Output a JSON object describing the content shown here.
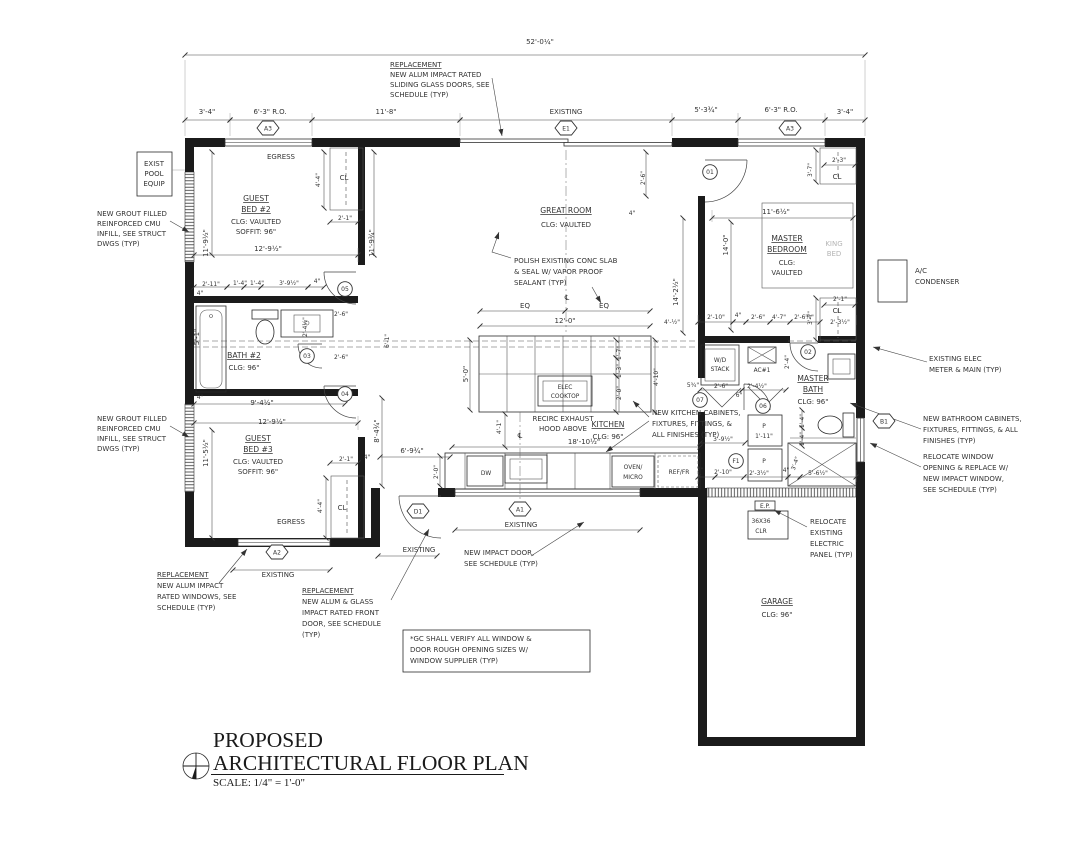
{
  "title_block": {
    "line1": "PROPOSED",
    "line2": "ARCHITECTURAL FLOOR PLAN",
    "scale": "SCALE: 1/4\" = 1'-0\""
  },
  "colors": {
    "ink": "#1b1b1b",
    "gray": "#b5b5b5",
    "bg": "#ffffff"
  },
  "hex_markers": [
    {
      "t": "A3",
      "x": 268,
      "y": 128
    },
    {
      "t": "E1",
      "x": 566,
      "y": 128
    },
    {
      "t": "A3",
      "x": 790,
      "y": 128
    },
    {
      "t": "A2",
      "x": 277,
      "y": 552
    },
    {
      "t": "D1",
      "x": 418,
      "y": 511
    },
    {
      "t": "A1",
      "x": 520,
      "y": 509
    },
    {
      "t": "B1",
      "x": 884,
      "y": 421
    }
  ],
  "circle_markers": [
    {
      "t": "01",
      "x": 710,
      "y": 172
    },
    {
      "t": "02",
      "x": 808,
      "y": 352
    },
    {
      "t": "05",
      "x": 345,
      "y": 289
    },
    {
      "t": "03",
      "x": 307,
      "y": 356
    },
    {
      "t": "04",
      "x": 345,
      "y": 394
    },
    {
      "t": "07",
      "x": 700,
      "y": 400
    },
    {
      "t": "06",
      "x": 763,
      "y": 406
    },
    {
      "t": "F1",
      "x": 736,
      "y": 461
    }
  ],
  "texts": [
    {
      "n": "dim-overall",
      "t": "52'-0¼\"",
      "x": 540,
      "y": 44
    },
    {
      "n": "note-slider-1",
      "t": "REPLACEMENT",
      "x": 390,
      "y": 67,
      "a": 1,
      "c": "u"
    },
    {
      "n": "note-slider-2",
      "t": "NEW ALUM IMPACT RATED",
      "x": 390,
      "y": 77,
      "a": 1
    },
    {
      "n": "note-slider-3",
      "t": "SLIDING GLASS DOORS, SEE",
      "x": 390,
      "y": 87,
      "a": 1
    },
    {
      "n": "note-slider-4",
      "t": "SCHEDULE (TYP)",
      "x": 390,
      "y": 97,
      "a": 1
    },
    {
      "t": "3'-4\"",
      "x": 207,
      "y": 114
    },
    {
      "t": "6'-3\" R.O.",
      "x": 270,
      "y": 114
    },
    {
      "t": "11'-8\"",
      "x": 386,
      "y": 114
    },
    {
      "t": "EXISTING",
      "x": 566,
      "y": 114
    },
    {
      "t": "5'-3¾\"",
      "x": 706,
      "y": 112
    },
    {
      "t": "6'-3\" R.O.",
      "x": 781,
      "y": 112
    },
    {
      "t": "3'-4\"",
      "x": 845,
      "y": 114
    },
    {
      "n": "label-pool-1",
      "t": "EXIST",
      "x": 154,
      "y": 166
    },
    {
      "n": "label-pool-2",
      "t": "POOL",
      "x": 154,
      "y": 176
    },
    {
      "n": "label-pool-3",
      "t": "EQUIP",
      "x": 154,
      "y": 186
    },
    {
      "n": "note-cmu1-1",
      "t": "NEW GROUT FILLED",
      "x": 97,
      "y": 216,
      "a": 1
    },
    {
      "n": "note-cmu1-2",
      "t": "REINFORCED CMU",
      "x": 97,
      "y": 226,
      "a": 1
    },
    {
      "n": "note-cmu1-3",
      "t": "INFILL, SEE STRUCT",
      "x": 97,
      "y": 236,
      "a": 1
    },
    {
      "n": "note-cmu1-4",
      "t": "DWGS (TYP)",
      "x": 97,
      "y": 246,
      "a": 1
    },
    {
      "n": "note-cmu2-1",
      "t": "NEW GROUT FILLED",
      "x": 97,
      "y": 421,
      "a": 1
    },
    {
      "n": "note-cmu2-2",
      "t": "REINFORCED CMU",
      "x": 97,
      "y": 431,
      "a": 1
    },
    {
      "n": "note-cmu2-3",
      "t": "INFILL, SEE STRUCT",
      "x": 97,
      "y": 441,
      "a": 1
    },
    {
      "n": "note-cmu2-4",
      "t": "DWGS (TYP)",
      "x": 97,
      "y": 451,
      "a": 1
    },
    {
      "n": "label-egress-top",
      "t": "EGRESS",
      "x": 281,
      "y": 159
    },
    {
      "n": "room-guest-bed-2",
      "t": "GUEST",
      "x": 256,
      "y": 201,
      "c": "room"
    },
    {
      "n": "room-guest-bed-2",
      "t": "BED #2",
      "x": 256,
      "y": 212,
      "c": "room"
    },
    {
      "t": "CLG: VAULTED",
      "x": 256,
      "y": 224
    },
    {
      "t": "SOFFIT: 96\"",
      "x": 256,
      "y": 234
    },
    {
      "t": "11'-9½\"",
      "x": 208,
      "y": 243,
      "r": -90
    },
    {
      "t": "4'-4\"",
      "x": 320,
      "y": 180,
      "r": -90,
      "c": "tiny"
    },
    {
      "n": "label-closet",
      "t": "CL",
      "x": 344,
      "y": 180
    },
    {
      "t": "2'-1\"",
      "x": 345,
      "y": 220,
      "c": "tiny"
    },
    {
      "t": "12'-9½\"",
      "x": 268,
      "y": 251
    },
    {
      "t": "11'-9¾\"",
      "x": 374,
      "y": 243,
      "r": -90
    },
    {
      "t": "2'-11\"",
      "x": 211,
      "y": 286,
      "c": "tiny"
    },
    {
      "t": "1'-4\"",
      "x": 240,
      "y": 285,
      "c": "tiny"
    },
    {
      "t": "1'-4\"",
      "x": 257,
      "y": 285,
      "c": "tiny"
    },
    {
      "t": "3'-9½\"",
      "x": 289,
      "y": 285,
      "c": "tiny"
    },
    {
      "t": "4\"",
      "x": 317,
      "y": 283,
      "c": "tiny"
    },
    {
      "t": "4\"",
      "x": 200,
      "y": 295,
      "c": "tiny"
    },
    {
      "t": "5'-1\"",
      "x": 199,
      "y": 337,
      "r": -90
    },
    {
      "n": "room-bath-2",
      "t": "BATH #2",
      "x": 244,
      "y": 358,
      "c": "room"
    },
    {
      "t": "CLG: 96\"",
      "x": 244,
      "y": 370
    },
    {
      "t": "2'-6\"",
      "x": 341,
      "y": 316,
      "c": "tiny"
    },
    {
      "t": "2'-4½\"",
      "x": 307,
      "y": 327,
      "r": -90,
      "c": "tiny"
    },
    {
      "t": "2'-6\"",
      "x": 341,
      "y": 359,
      "c": "tiny"
    },
    {
      "t": "6'-1\"",
      "x": 389,
      "y": 341,
      "r": -90,
      "c": "tiny"
    },
    {
      "t": "4\"",
      "x": 200,
      "y": 399,
      "c": "tiny"
    },
    {
      "t": "9'-4½\"",
      "x": 262,
      "y": 405
    },
    {
      "t": "12'-9½\"",
      "x": 272,
      "y": 424
    },
    {
      "t": "11'-5½\"",
      "x": 208,
      "y": 453,
      "r": -90
    },
    {
      "t": "8'-4¾\"",
      "x": 379,
      "y": 431,
      "r": -90
    },
    {
      "n": "room-guest-bed-3",
      "t": "GUEST",
      "x": 258,
      "y": 441,
      "c": "room"
    },
    {
      "n": "room-guest-bed-3",
      "t": "BED #3",
      "x": 258,
      "y": 452,
      "c": "room"
    },
    {
      "t": "CLG: VAULTED",
      "x": 258,
      "y": 464
    },
    {
      "t": "SOFFIT: 96\"",
      "x": 258,
      "y": 474
    },
    {
      "t": "2'-1\"",
      "x": 346,
      "y": 461,
      "c": "tiny"
    },
    {
      "t": "4\"",
      "x": 367,
      "y": 459,
      "c": "tiny"
    },
    {
      "t": "4'-4\"",
      "x": 322,
      "y": 506,
      "r": -90,
      "c": "tiny"
    },
    {
      "n": "label-closet",
      "t": "CL",
      "x": 342,
      "y": 510
    },
    {
      "n": "label-egress-bottom",
      "t": "EGRESS",
      "x": 291,
      "y": 524
    },
    {
      "t": "EXISTING",
      "x": 278,
      "y": 577
    },
    {
      "n": "room-great-room",
      "t": "GREAT ROOM",
      "x": 566,
      "y": 213,
      "c": "room"
    },
    {
      "t": "CLG: VAULTED",
      "x": 566,
      "y": 227
    },
    {
      "n": "note-slab-1",
      "t": "POLISH EXISTING CONC SLAB",
      "x": 514,
      "y": 263,
      "a": 1
    },
    {
      "n": "note-slab-2",
      "t": "& SEAL W/ VAPOR PROOF",
      "x": 514,
      "y": 274,
      "a": 1
    },
    {
      "n": "note-slab-3",
      "t": "SEALANT (TYP)",
      "x": 514,
      "y": 285,
      "a": 1
    },
    {
      "n": "centerline-symbol",
      "t": "℄",
      "x": 567,
      "y": 300
    },
    {
      "t": "EQ",
      "x": 525,
      "y": 308
    },
    {
      "t": "EQ",
      "x": 604,
      "y": 308
    },
    {
      "t": "12'-0\"",
      "x": 565,
      "y": 323
    },
    {
      "t": "14'-2½\"",
      "x": 678,
      "y": 292,
      "r": -90
    },
    {
      "t": "4'-½\"",
      "x": 672,
      "y": 324,
      "c": "tiny"
    },
    {
      "t": "2'-6\"",
      "x": 645,
      "y": 178,
      "r": -90,
      "c": "tiny"
    },
    {
      "t": "4\"",
      "x": 632,
      "y": 215,
      "c": "tiny"
    },
    {
      "t": "14'-0\"",
      "x": 728,
      "y": 245,
      "r": -90
    },
    {
      "t": "11'-6½\"",
      "x": 776,
      "y": 214
    },
    {
      "n": "room-master-bedroom",
      "t": "MASTER",
      "x": 787,
      "y": 241,
      "c": "room"
    },
    {
      "n": "room-master-bedroom",
      "t": "BEDROOM",
      "x": 787,
      "y": 252,
      "c": "room"
    },
    {
      "t": "CLG:",
      "x": 787,
      "y": 265
    },
    {
      "t": "VAULTED",
      "x": 787,
      "y": 275
    },
    {
      "n": "label-king-bed",
      "t": "KING",
      "x": 834,
      "y": 246,
      "c": "gray"
    },
    {
      "n": "label-king-bed",
      "t": "BED",
      "x": 834,
      "y": 256,
      "c": "gray"
    },
    {
      "t": "2'-3\"",
      "x": 839,
      "y": 162,
      "c": "tiny"
    },
    {
      "n": "label-closet",
      "t": "CL",
      "x": 837,
      "y": 179
    },
    {
      "t": "3'-7\"",
      "x": 812,
      "y": 170,
      "r": -90,
      "c": "tiny"
    },
    {
      "t": "2'-1\"",
      "x": 840,
      "y": 301,
      "c": "tiny"
    },
    {
      "n": "label-closet",
      "t": "CL",
      "x": 837,
      "y": 313
    },
    {
      "t": "2'-3½\"",
      "x": 840,
      "y": 324,
      "c": "tiny"
    },
    {
      "t": "3'-7\"",
      "x": 812,
      "y": 318,
      "r": -90,
      "c": "tiny"
    },
    {
      "t": "2'-10\"",
      "x": 716,
      "y": 319,
      "c": "tiny"
    },
    {
      "t": "4\"",
      "x": 738,
      "y": 317,
      "c": "tiny"
    },
    {
      "t": "2'-6\"",
      "x": 758,
      "y": 319,
      "c": "tiny"
    },
    {
      "t": "4'-7\"",
      "x": 779,
      "y": 319,
      "c": "tiny"
    },
    {
      "t": "2'-6⅝\"",
      "x": 804,
      "y": 319,
      "c": "tiny"
    },
    {
      "n": "label-wd-stack",
      "t": "W/D",
      "x": 720,
      "y": 362,
      "c": "tiny"
    },
    {
      "n": "label-wd-stack",
      "t": "STACK",
      "x": 720,
      "y": 371,
      "c": "tiny"
    },
    {
      "n": "label-ac1",
      "t": "AC#1",
      "x": 762,
      "y": 372,
      "c": "tiny"
    },
    {
      "t": "2'-6\"",
      "x": 721,
      "y": 388,
      "c": "tiny"
    },
    {
      "t": "2'-4½\"",
      "x": 757,
      "y": 388,
      "c": "tiny"
    },
    {
      "t": "6\"",
      "x": 739,
      "y": 397,
      "c": "tiny"
    },
    {
      "t": "5¾\"",
      "x": 693,
      "y": 387,
      "c": "tiny"
    },
    {
      "t": "2'-4\"",
      "x": 789,
      "y": 362,
      "r": -90,
      "c": "tiny"
    },
    {
      "n": "room-master-bath",
      "t": "MASTER",
      "x": 813,
      "y": 381,
      "c": "room"
    },
    {
      "n": "room-master-bath",
      "t": "BATH",
      "x": 813,
      "y": 392,
      "c": "room"
    },
    {
      "t": "CLG: 96\"",
      "x": 813,
      "y": 404
    },
    {
      "t": "1'-4\"",
      "x": 804,
      "y": 421,
      "r": -90,
      "c": "tiny"
    },
    {
      "t": "1'-4\"",
      "x": 804,
      "y": 439,
      "r": -90,
      "c": "tiny"
    },
    {
      "t": "5'-0\"",
      "x": 468,
      "y": 374,
      "r": -90
    },
    {
      "n": "label-cooktop",
      "t": "ELEC",
      "x": 565,
      "y": 389,
      "c": "tiny"
    },
    {
      "n": "label-cooktop",
      "t": "COOKTOP",
      "x": 565,
      "y": 398,
      "c": "tiny"
    },
    {
      "n": "note-hood-1",
      "t": "RECIRC EXHAUST",
      "x": 563,
      "y": 421
    },
    {
      "n": "note-hood-2",
      "t": "HOOD ABOVE",
      "x": 563,
      "y": 431
    },
    {
      "n": "room-kitchen",
      "t": "KITCHEN",
      "x": 608,
      "y": 427,
      "c": "room"
    },
    {
      "t": "CLG: 96\"",
      "x": 608,
      "y": 439
    },
    {
      "t": "1'-7\"",
      "x": 621,
      "y": 353,
      "r": -90,
      "c": "tiny"
    },
    {
      "t": "1'-3\"",
      "x": 621,
      "y": 371,
      "r": -90,
      "c": "tiny"
    },
    {
      "t": "2'-0\"",
      "x": 621,
      "y": 393,
      "r": -90,
      "c": "tiny"
    },
    {
      "t": "4'-10\"",
      "x": 658,
      "y": 377,
      "r": -90,
      "c": "tiny"
    },
    {
      "t": "4'-1\"",
      "x": 501,
      "y": 427,
      "r": -90,
      "c": "tiny"
    },
    {
      "n": "centerline-symbol",
      "t": "℄",
      "x": 520,
      "y": 438
    },
    {
      "t": "18'-10½\"",
      "x": 584,
      "y": 444
    },
    {
      "t": "2'-0\"",
      "x": 438,
      "y": 472,
      "r": -90,
      "c": "tiny"
    },
    {
      "t": "6'-9¾\"",
      "x": 412,
      "y": 453
    },
    {
      "n": "label-dishwasher",
      "t": "DW",
      "x": 486,
      "y": 475,
      "c": "tiny"
    },
    {
      "n": "label-oven",
      "t": "OVEN/",
      "x": 633,
      "y": 469,
      "c": "tiny"
    },
    {
      "n": "label-oven",
      "t": "MICRO",
      "x": 633,
      "y": 479,
      "c": "tiny"
    },
    {
      "n": "label-fridge",
      "t": "REF/FR",
      "x": 679,
      "y": 474,
      "c": "tiny"
    },
    {
      "n": "note-kitchen-cab-1",
      "t": "NEW KITCHEN CABINETS,",
      "x": 652,
      "y": 415,
      "a": 1
    },
    {
      "n": "note-kitchen-cab-2",
      "t": "FIXTURES, FITTINGS, &",
      "x": 652,
      "y": 426,
      "a": 1
    },
    {
      "n": "note-kitchen-cab-3",
      "t": "ALL FINISHES (TYP)",
      "x": 652,
      "y": 437,
      "a": 1
    },
    {
      "n": "label-pantry",
      "t": "P",
      "x": 764,
      "y": 428,
      "c": "tiny"
    },
    {
      "t": "1'-11\"",
      "x": 764,
      "y": 438,
      "c": "tiny"
    },
    {
      "n": "label-pantry",
      "t": "P",
      "x": 764,
      "y": 463,
      "c": "tiny"
    },
    {
      "t": "3'-9½\"",
      "x": 723,
      "y": 441,
      "c": "tiny"
    },
    {
      "t": "2'-10\"",
      "x": 723,
      "y": 474,
      "c": "tiny"
    },
    {
      "t": "7\"",
      "x": 700,
      "y": 472,
      "c": "tiny"
    },
    {
      "t": "2'-3½\"",
      "x": 759,
      "y": 475,
      "c": "tiny"
    },
    {
      "t": "4\"",
      "x": 786,
      "y": 472,
      "c": "tiny"
    },
    {
      "t": "5'-6½\"",
      "x": 818,
      "y": 475,
      "c": "tiny"
    },
    {
      "t": "3'-4\"",
      "x": 797,
      "y": 464,
      "r": -70,
      "c": "tiny"
    },
    {
      "n": "label-ac-cond-1",
      "t": "A/C",
      "x": 915,
      "y": 273,
      "a": 1
    },
    {
      "n": "label-ac-cond-2",
      "t": "CONDENSER",
      "x": 915,
      "y": 284,
      "a": 1
    },
    {
      "n": "note-meter-1",
      "t": "EXISTING ELEC",
      "x": 929,
      "y": 361,
      "a": 1
    },
    {
      "n": "note-meter-2",
      "t": "METER & MAIN (TYP)",
      "x": 929,
      "y": 372,
      "a": 1
    },
    {
      "n": "note-bath-cab-1",
      "t": "NEW  BATHROOM CABINETS,",
      "x": 923,
      "y": 421,
      "a": 1
    },
    {
      "n": "note-bath-cab-2",
      "t": "FIXTURES, FITTINGS, & ALL",
      "x": 923,
      "y": 432,
      "a": 1
    },
    {
      "n": "note-bath-cab-3",
      "t": "FINISHES (TYP)",
      "x": 923,
      "y": 443,
      "a": 1
    },
    {
      "n": "note-reloc-win-1",
      "t": "RELOCATE WINDOW",
      "x": 923,
      "y": 459,
      "a": 1
    },
    {
      "n": "note-reloc-win-2",
      "t": "OPENING & REPLACE W/",
      "x": 923,
      "y": 470,
      "a": 1
    },
    {
      "n": "note-reloc-win-3",
      "t": "NEW IMPACT WINDOW,",
      "x": 923,
      "y": 481,
      "a": 1
    },
    {
      "n": "note-reloc-win-4",
      "t": "SEE SCHEDULE (TYP)",
      "x": 923,
      "y": 492,
      "a": 1
    },
    {
      "n": "label-elec-panel",
      "t": "E.P.",
      "x": 765,
      "y": 508,
      "c": "tiny"
    },
    {
      "n": "label-clear-1",
      "t": "36X36",
      "x": 761,
      "y": 523,
      "c": "tiny"
    },
    {
      "n": "label-clear-2",
      "t": "CLR",
      "x": 761,
      "y": 533,
      "c": "tiny"
    },
    {
      "n": "note-panel-1",
      "t": "RELOCATE",
      "x": 810,
      "y": 524,
      "a": 1
    },
    {
      "n": "note-panel-2",
      "t": "EXISTING",
      "x": 810,
      "y": 535,
      "a": 1
    },
    {
      "n": "note-panel-3",
      "t": "ELECTRIC",
      "x": 810,
      "y": 546,
      "a": 1
    },
    {
      "n": "note-panel-4",
      "t": "PANEL (TYP)",
      "x": 810,
      "y": 557,
      "a": 1
    },
    {
      "n": "room-garage",
      "t": "GARAGE",
      "x": 777,
      "y": 604,
      "c": "room"
    },
    {
      "t": "CLG: 96\"",
      "x": 777,
      "y": 617
    },
    {
      "t": "EXISTING",
      "x": 521,
      "y": 527
    },
    {
      "t": "EXISTING",
      "x": 419,
      "y": 552
    },
    {
      "n": "note-impact-door-1",
      "t": "NEW IMPACT DOOR,",
      "x": 464,
      "y": 555,
      "a": 1
    },
    {
      "n": "note-impact-door-2",
      "t": "SEE SCHEDULE (TYP)",
      "x": 464,
      "y": 566,
      "a": 1
    },
    {
      "n": "note-repl-win-1",
      "t": "REPLACEMENT",
      "x": 157,
      "y": 577,
      "a": 1,
      "c": "u"
    },
    {
      "n": "note-repl-win-2",
      "t": "NEW ALUM IMPACT",
      "x": 157,
      "y": 588,
      "a": 1
    },
    {
      "n": "note-repl-win-3",
      "t": "RATED WINDOWS, SEE",
      "x": 157,
      "y": 599,
      "a": 1
    },
    {
      "n": "note-repl-win-4",
      "t": "SCHEDULE (TYP)",
      "x": 157,
      "y": 610,
      "a": 1
    },
    {
      "n": "note-front-door-1",
      "t": "REPLACEMENT",
      "x": 302,
      "y": 593,
      "a": 1,
      "c": "u"
    },
    {
      "n": "note-front-door-2",
      "t": "NEW ALUM & GLASS",
      "x": 302,
      "y": 604,
      "a": 1
    },
    {
      "n": "note-front-door-3",
      "t": "IMPACT RATED FRONT",
      "x": 302,
      "y": 615,
      "a": 1
    },
    {
      "n": "note-front-door-4",
      "t": "DOOR, SEE SCHEDULE",
      "x": 302,
      "y": 626,
      "a": 1
    },
    {
      "n": "note-front-door-5",
      "t": "(TYP)",
      "x": 302,
      "y": 637,
      "a": 1
    },
    {
      "n": "note-gc-1",
      "t": "*GC SHALL VERIFY ALL WINDOW &",
      "x": 410,
      "y": 641,
      "a": 1
    },
    {
      "n": "note-gc-2",
      "t": "DOOR ROUGH OPENING SIZES W/",
      "x": 410,
      "y": 652,
      "a": 1
    },
    {
      "n": "note-gc-3",
      "t": "WINDOW SUPPLIER (TYP)",
      "x": 410,
      "y": 663,
      "a": 1
    }
  ]
}
